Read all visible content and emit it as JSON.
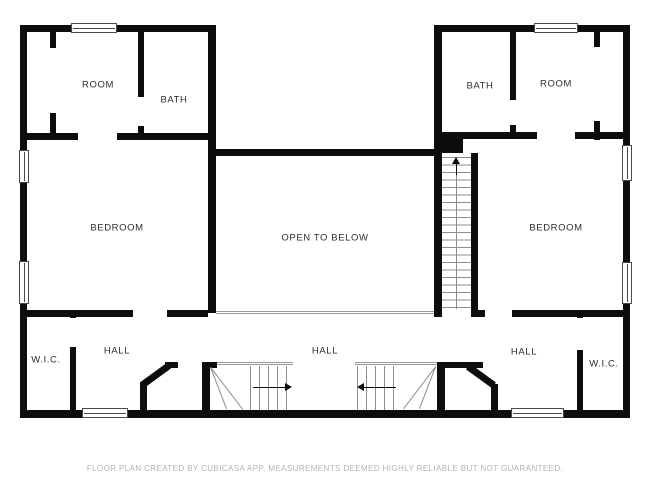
{
  "floor_plan": {
    "labels": [
      {
        "id": "room-left",
        "text": "ROOM"
      },
      {
        "id": "bath-left",
        "text": "BATH"
      },
      {
        "id": "bath-right",
        "text": "BATH"
      },
      {
        "id": "room-right",
        "text": "ROOM"
      },
      {
        "id": "bedroom-left",
        "text": "BEDROOM"
      },
      {
        "id": "open-to-below",
        "text": "OPEN TO BELOW"
      },
      {
        "id": "bedroom-right",
        "text": "BEDROOM"
      },
      {
        "id": "wic-left",
        "text": "W.I.C."
      },
      {
        "id": "hall-left",
        "text": "HALL"
      },
      {
        "id": "hall-center",
        "text": "HALL"
      },
      {
        "id": "hall-right",
        "text": "HALL"
      },
      {
        "id": "wic-right",
        "text": "W.I.C."
      }
    ],
    "footer_disclaimer": "FLOOR PLAN CREATED BY CUBICASA APP. MEASUREMENTS DEEMED HIGHLY RELIABLE BUT NOT GUARANTEED.",
    "icons": {
      "stair_up_arrow": "triangle-up",
      "stair_right_arrow": "triangle-right",
      "stair_left_arrow": "triangle-left"
    },
    "colors": {
      "background": "#ffffff",
      "wall": "#0d0d0d",
      "label_text": "#2e2e2e",
      "footer_text": "#b3b3b3",
      "stair_line": "#8c8c8c",
      "window_frame": "#4a4a4a"
    }
  }
}
